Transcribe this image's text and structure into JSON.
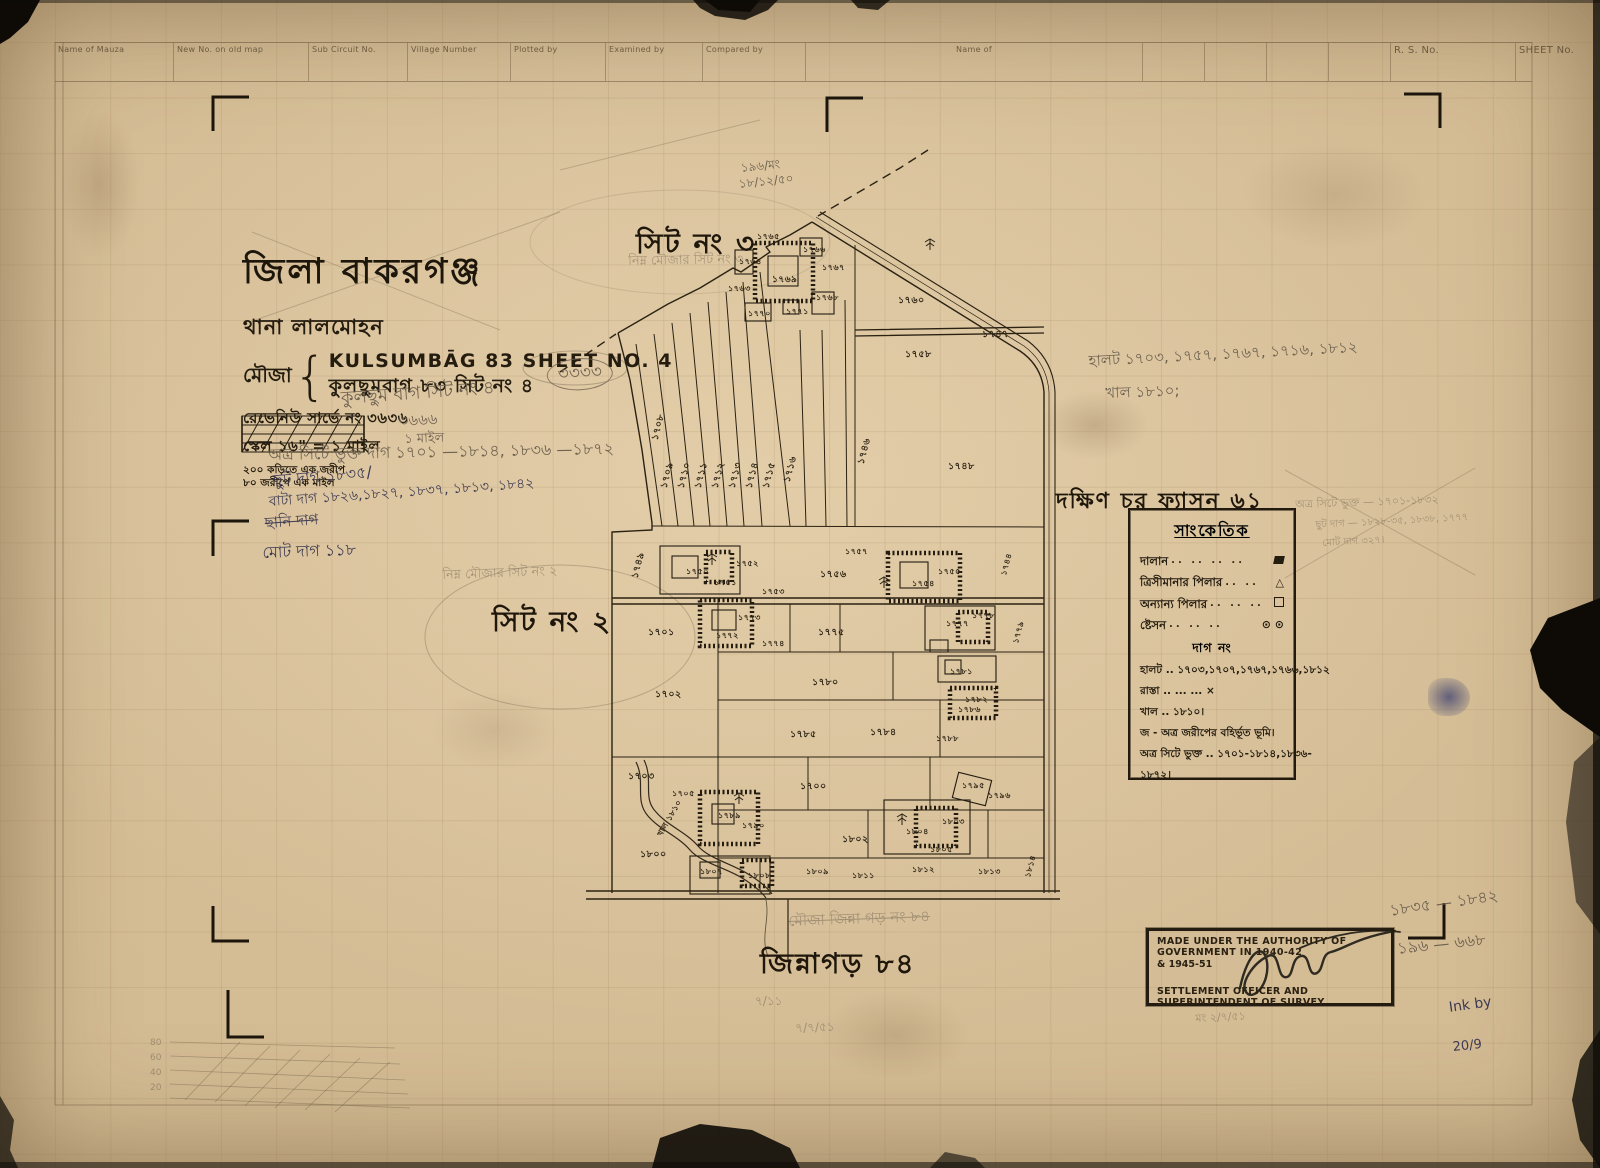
{
  "form_header": {
    "columns": [
      "Name of Mauza",
      "New No. on old map",
      "Sub Circuit No.",
      "Village Number",
      "Plotted by",
      "Examined by",
      "Compared by",
      "Name of"
    ],
    "rs_no": "R. S. No.",
    "sheet_no": "SHEET No."
  },
  "title_block": {
    "district": "জিলা বাকরগঞ্জ",
    "thana": "থানা লালমোহন",
    "mouza_label": "মৌজা",
    "name_en": "KULSUMBĀG 83 SHEET NO. 4",
    "name_bn": "কুলছুমবাগ ৮৩ সিট নং ৪",
    "revenue": "রেভেনিউ সার্ভে নং ৩৬৩৬",
    "scale": "স্কেল ১৬\" = ১ মাইল",
    "note1": "২০০ কড়িতে এক জরীপ",
    "note2": "৮০ জরীপে এক মাইল"
  },
  "area_labels": {
    "north": "সিট নং ৩",
    "west": "সিট নং ২",
    "east": "দক্ষিণ চর ফ্যাসন ৬১",
    "south": "জিন্নাগড় ৮৪"
  },
  "legend": {
    "title": "সাংকেতিক",
    "symbol_rows": [
      {
        "label": "দালান",
        "leader": "..  ..  ..  ..",
        "symbol": "building"
      },
      {
        "label": "ত্রিসীমানার পিলার",
        "leader": "..  ..",
        "symbol": "triangle",
        "glyph": "△"
      },
      {
        "label": "অন্যান্য পিলার",
        "leader": "..  ..  ..",
        "symbol": "square"
      },
      {
        "label": "ষ্টেসন",
        "leader": "..  ..  ..",
        "symbol": "station",
        "glyph": "⊙ ⊙"
      }
    ],
    "dag_heading": "দাগ নং",
    "text_rows": [
      "হালট .. ১৭০৩,১৭০৭,১৭৬৭,১৭৬৬,১৮১২",
      "রাস্তা ..     ...      ... ×",
      "খাল .. ১৮১০।",
      "জ - অত্র জরীপের বহির্ভূত ভূমি।",
      "অত্র সিটে ভুক্ত .. ১৭০১-১৮১৪,১৮৩৬-",
      "১৮৭২।"
    ]
  },
  "stamp": {
    "line1": "MADE UNDER THE AUTHORITY OF GOVERNMENT IN 1940-42",
    "line2": "& 1945-51",
    "line3": "SETTLEMENT OFFICER AND SUPERINTENDENT OF SURVEY"
  },
  "sketch_labels": [
    "80",
    "60",
    "40",
    "20"
  ],
  "map": {
    "plots": [
      {
        "x": 646,
        "y": 420,
        "t": "১৭০৮",
        "r": -75
      },
      {
        "x": 655,
        "y": 468,
        "t": "১৭০৯",
        "r": -75
      },
      {
        "x": 672,
        "y": 468,
        "t": "১৭১০",
        "r": -75
      },
      {
        "x": 689,
        "y": 468,
        "t": "১৭১১",
        "r": -75
      },
      {
        "x": 706,
        "y": 468,
        "t": "১৭১২",
        "r": -75
      },
      {
        "x": 723,
        "y": 468,
        "t": "১৭১৩",
        "r": -75
      },
      {
        "x": 740,
        "y": 468,
        "t": "১৭১৪",
        "r": -75
      },
      {
        "x": 757,
        "y": 468,
        "t": "১৭১৫",
        "r": -75
      },
      {
        "x": 778,
        "y": 462,
        "t": "১৭১৬",
        "r": -75
      },
      {
        "x": 739,
        "y": 256,
        "t": "১৭৬৪",
        "s": 8
      },
      {
        "x": 772,
        "y": 272,
        "t": "১৭৬৯",
        "s": 9
      },
      {
        "x": 803,
        "y": 244,
        "t": "১৭৬৬",
        "s": 8
      },
      {
        "x": 822,
        "y": 262,
        "t": "১৭৬৭",
        "s": 8
      },
      {
        "x": 816,
        "y": 292,
        "t": "১৭৬৮",
        "s": 8
      },
      {
        "x": 748,
        "y": 308,
        "t": "১৭৭০",
        "s": 8
      },
      {
        "x": 728,
        "y": 283,
        "t": "১৭৬৩",
        "s": 8
      },
      {
        "x": 786,
        "y": 306,
        "t": "১৭৭১",
        "s": 8
      },
      {
        "x": 757,
        "y": 231,
        "t": "১৭৬৫",
        "s": 8
      },
      {
        "x": 898,
        "y": 294,
        "t": "১৭৬০"
      },
      {
        "x": 905,
        "y": 348,
        "t": "১৭৫৮"
      },
      {
        "x": 948,
        "y": 460,
        "t": "১৭৪৮"
      },
      {
        "x": 852,
        "y": 444,
        "t": "১৭৪৬",
        "r": -75
      },
      {
        "x": 982,
        "y": 328,
        "t": "১৭৪৭"
      },
      {
        "x": 626,
        "y": 558,
        "t": "১৭৪৯",
        "r": -75
      },
      {
        "x": 686,
        "y": 566,
        "t": "১৭৫০",
        "s": 8
      },
      {
        "x": 714,
        "y": 577,
        "t": "১৭৫১",
        "s": 8
      },
      {
        "x": 736,
        "y": 558,
        "t": "১৭৫২",
        "s": 8
      },
      {
        "x": 762,
        "y": 586,
        "t": "১৭৫৩",
        "s": 8
      },
      {
        "x": 820,
        "y": 568,
        "t": "১৭৫৬"
      },
      {
        "x": 845,
        "y": 546,
        "t": "১৭৫৭",
        "s": 8
      },
      {
        "x": 912,
        "y": 578,
        "t": "১৭৫৪",
        "s": 8
      },
      {
        "x": 938,
        "y": 566,
        "t": "১৭৫৫",
        "s": 8
      },
      {
        "x": 996,
        "y": 558,
        "t": "১৭৪৪",
        "r": -75,
        "s": 8
      },
      {
        "x": 648,
        "y": 626,
        "t": "১৭০১"
      },
      {
        "x": 716,
        "y": 630,
        "t": "১৭৭২",
        "s": 8
      },
      {
        "x": 738,
        "y": 612,
        "t": "১৭৭৩",
        "s": 8
      },
      {
        "x": 762,
        "y": 638,
        "t": "১৭৭৪",
        "s": 8
      },
      {
        "x": 818,
        "y": 626,
        "t": "১৭৭৫"
      },
      {
        "x": 946,
        "y": 618,
        "t": "১৭৭৭",
        "s": 8
      },
      {
        "x": 972,
        "y": 610,
        "t": "১৭৭৮",
        "s": 8
      },
      {
        "x": 1008,
        "y": 626,
        "t": "১৭৭৯",
        "r": -75,
        "s": 8
      },
      {
        "x": 655,
        "y": 688,
        "t": "১৭০২"
      },
      {
        "x": 812,
        "y": 676,
        "t": "১৭৮০"
      },
      {
        "x": 950,
        "y": 666,
        "t": "১৭৮১",
        "s": 8
      },
      {
        "x": 965,
        "y": 694,
        "t": "১৭৮২",
        "s": 8
      },
      {
        "x": 790,
        "y": 728,
        "t": "১৭৮৫"
      },
      {
        "x": 870,
        "y": 726,
        "t": "১৭৮৪"
      },
      {
        "x": 958,
        "y": 704,
        "t": "১৭৮৬",
        "s": 8
      },
      {
        "x": 936,
        "y": 733,
        "t": "১৭৮৮",
        "s": 8
      },
      {
        "x": 628,
        "y": 770,
        "t": "১৭০৩"
      },
      {
        "x": 672,
        "y": 788,
        "t": "১৭০৫",
        "s": 8
      },
      {
        "x": 718,
        "y": 810,
        "t": "১৭৮৯",
        "s": 8
      },
      {
        "x": 742,
        "y": 820,
        "t": "১৭৯০",
        "s": 8
      },
      {
        "x": 800,
        "y": 780,
        "t": "১৭০০"
      },
      {
        "x": 842,
        "y": 833,
        "t": "১৮০২"
      },
      {
        "x": 906,
        "y": 826,
        "t": "১৮০৪",
        "s": 8
      },
      {
        "x": 942,
        "y": 816,
        "t": "১৮০৩",
        "s": 8
      },
      {
        "x": 930,
        "y": 844,
        "t": "১৮০৫",
        "s": 8
      },
      {
        "x": 962,
        "y": 780,
        "t": "১৭৯৫",
        "s": 8
      },
      {
        "x": 988,
        "y": 790,
        "t": "১৭৯৬",
        "s": 8
      },
      {
        "x": 640,
        "y": 848,
        "t": "১৮০০"
      },
      {
        "x": 700,
        "y": 866,
        "t": "১৮০৭",
        "s": 8
      },
      {
        "x": 748,
        "y": 870,
        "t": "১৮০৮",
        "s": 8
      },
      {
        "x": 806,
        "y": 866,
        "t": "১৮০৯",
        "s": 8
      },
      {
        "x": 852,
        "y": 870,
        "t": "১৮১১",
        "s": 8
      },
      {
        "x": 912,
        "y": 864,
        "t": "১৮১২",
        "s": 8
      },
      {
        "x": 978,
        "y": 866,
        "t": "১৮১৩",
        "s": 8
      },
      {
        "x": 1020,
        "y": 860,
        "t": "১৮১৪",
        "r": -75,
        "s": 8
      },
      {
        "x": 650,
        "y": 812,
        "t": "খাল ১৮১০",
        "r": -60,
        "s": 8
      }
    ]
  },
  "handwriting": [
    {
      "x": 740,
      "y": 160,
      "r": -6,
      "s": 12,
      "c": "pencil",
      "t": "১৯৬/মং"
    },
    {
      "x": 738,
      "y": 176,
      "r": -6,
      "s": 12,
      "c": "pencil",
      "t": "১৮/১২/৫০"
    },
    {
      "x": 628,
      "y": 252,
      "r": -1,
      "s": 13,
      "c": "pencil faint",
      "t": "নিম্ন মৌজার সিট নং ৩"
    },
    {
      "x": 442,
      "y": 566,
      "r": -2,
      "s": 13,
      "c": "pencil faint",
      "t": "নিম্ন মৌজার সিট নং ২"
    },
    {
      "x": 1088,
      "y": 350,
      "r": -3,
      "s": 15,
      "c": "pencil",
      "t": "হালট ১৭০৩, ১৭৫৭, ১৭৬৭, ১৭১৬, ১৮১২"
    },
    {
      "x": 1105,
      "y": 382,
      "r": -2,
      "s": 15,
      "c": "pencil",
      "t": "খাল ১৮১০;"
    },
    {
      "x": 1295,
      "y": 496,
      "r": -2,
      "s": 11,
      "c": "pencil faint",
      "t": "অত্র সিটে ভুক্ত — ১৭০১-১৮৩২"
    },
    {
      "x": 1315,
      "y": 518,
      "r": -3,
      "s": 10,
      "c": "pencil faint",
      "t": "ছুট দাগ — ১৮২৮-৩৫, ১৮৩৮, ১৭৭৭"
    },
    {
      "x": 1322,
      "y": 536,
      "r": -3,
      "s": 10,
      "c": "pencil faint",
      "t": "মোট দাগ ৩২৭।"
    },
    {
      "x": 788,
      "y": 910,
      "r": -2,
      "s": 15,
      "c": "pencil strike faint",
      "t": "মৌজা জিন্না গড় নং ৮৪"
    },
    {
      "x": 1388,
      "y": 898,
      "r": -8,
      "s": 16,
      "c": "pencil",
      "t": "১৮৩৫ — ১৮৪২"
    },
    {
      "x": 1396,
      "y": 936,
      "r": -6,
      "s": 16,
      "c": "pencil",
      "t": "১৯৬ — ৬৬৮"
    },
    {
      "x": 1448,
      "y": 1000,
      "r": -8,
      "s": 14,
      "c": "ink",
      "t": "Ink by"
    },
    {
      "x": 1452,
      "y": 1040,
      "r": -6,
      "s": 13,
      "c": "ink",
      "t": "20/9"
    },
    {
      "x": 340,
      "y": 384,
      "r": -4,
      "s": 18,
      "c": "pencil",
      "t": "কুলছুম বাগ   সিট নং ৪"
    },
    {
      "x": 398,
      "y": 410,
      "r": -3,
      "s": 15,
      "c": "pencil",
      "t": "৩৬৬৬"
    },
    {
      "x": 404,
      "y": 430,
      "r": -2,
      "s": 13,
      "c": "pencil",
      "t": "১ মাইল"
    },
    {
      "x": 546,
      "y": 360,
      "r": -3,
      "s": 17,
      "c": "pencil circled",
      "t": "৩৩৩৩"
    },
    {
      "x": 268,
      "y": 442,
      "r": -1,
      "s": 16,
      "c": "pencil",
      "t": "অত্র সিটে ভুক্ত দাগ  ১৭০১ —১৮১৪, ১৮৩৬ —১৮৭২"
    },
    {
      "x": 272,
      "y": 468,
      "r": -5,
      "s": 16,
      "c": "ink",
      "t": "ছুট দাগ   ১৮৩৫/"
    },
    {
      "x": 268,
      "y": 490,
      "r": -4,
      "s": 14,
      "c": "ink",
      "t": "বাটা দাগ  ১৮২৬,১৮২৭, ১৮৩৭, ১৮১৩, ১৮৪২"
    },
    {
      "x": 264,
      "y": 512,
      "r": -4,
      "s": 15,
      "c": "ink strike",
      "t": "ছানি দাগ"
    },
    {
      "x": 262,
      "y": 540,
      "r": -2,
      "s": 16,
      "c": "ink",
      "t": "মোট দাগ    ১১৮"
    },
    {
      "x": 755,
      "y": 993,
      "r": 0,
      "s": 12,
      "c": "pencil faint",
      "t": "৭/১১"
    },
    {
      "x": 795,
      "y": 1020,
      "r": -2,
      "s": 12,
      "c": "pencil faint",
      "t": "৭/৭/৫১"
    },
    {
      "x": 1195,
      "y": 1010,
      "r": -3,
      "s": 11,
      "c": "pencil faint",
      "t": "মং ২/৭/৫১"
    }
  ]
}
